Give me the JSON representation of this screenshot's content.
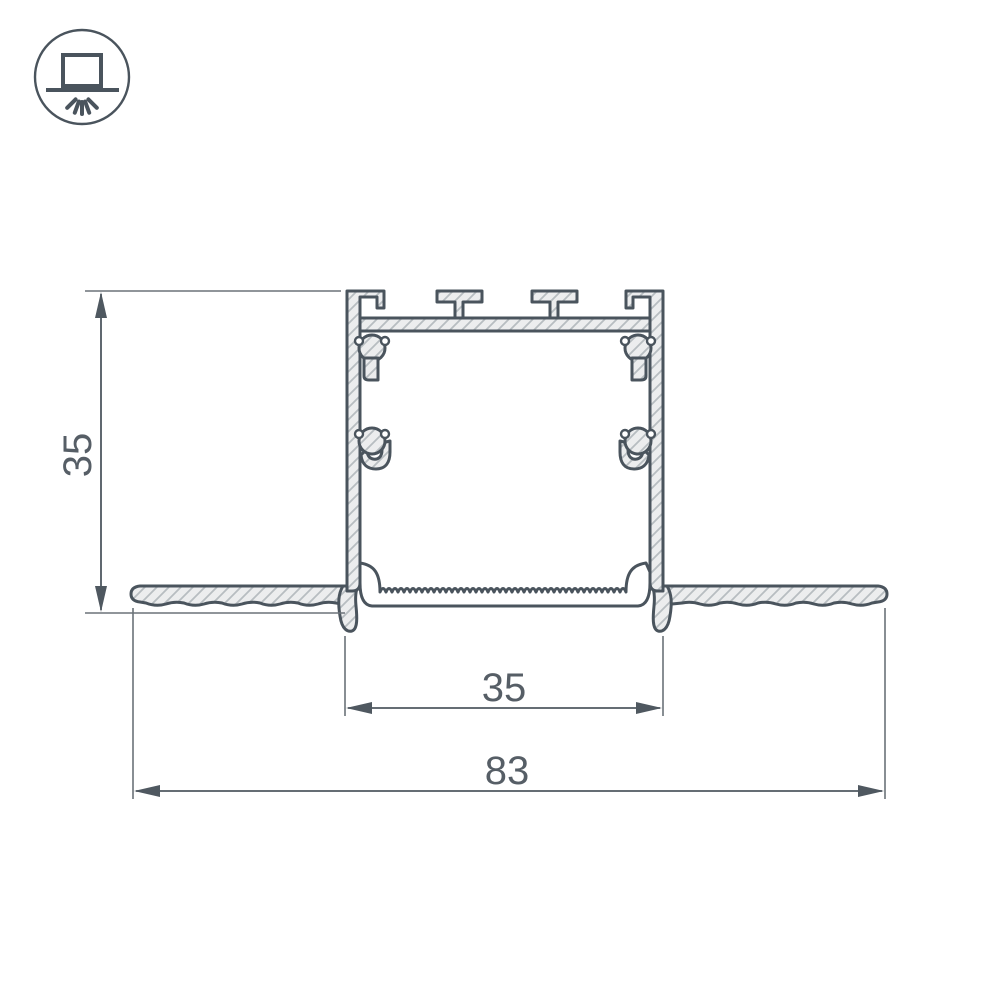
{
  "icon": {
    "name": "recessed-light-icon",
    "description": "recessed ceiling luminaire symbol"
  },
  "dimensions": {
    "profile_height": {
      "value": "35",
      "orientation": "vertical"
    },
    "inner_width": {
      "value": "35",
      "orientation": "horizontal"
    },
    "overall_width": {
      "value": "83",
      "orientation": "horizontal"
    }
  },
  "colors": {
    "outline": "#4a545d",
    "dimension_line": "#4f5860",
    "extension_line": "#6b7278",
    "dimension_text": "#565e66",
    "hatch_fill": "#ecedee",
    "hatch_line": "#b7bdc1",
    "background": "#ffffff"
  }
}
